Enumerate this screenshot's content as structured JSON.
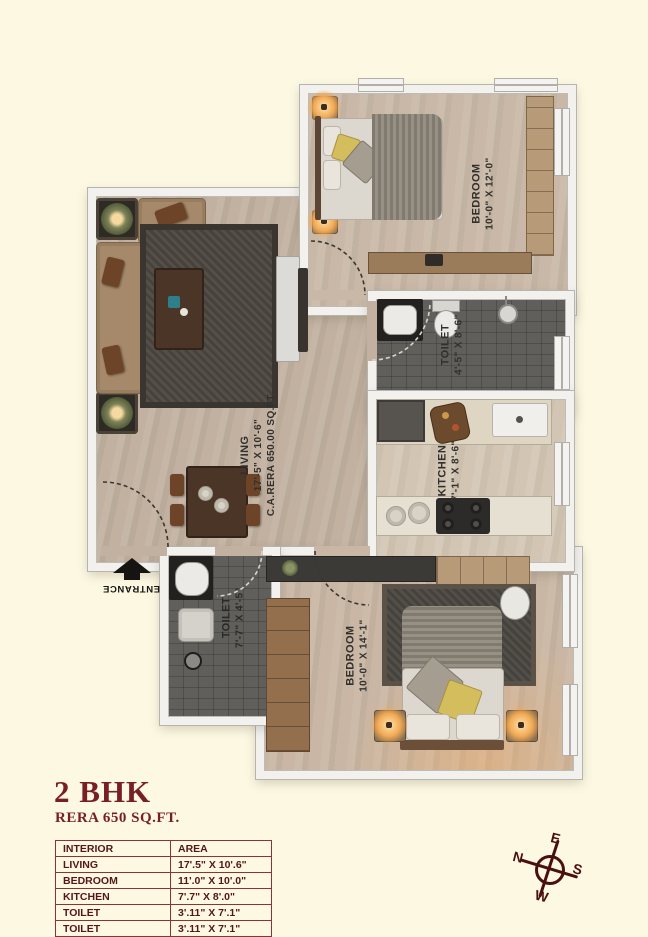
{
  "title": {
    "heading": "2 BHK",
    "subheading": "RERA 650 SQ.FT."
  },
  "plan": {
    "entrance_label": "ENTRANCE",
    "rooms": {
      "bedroom1": {
        "name": "BEDROOM",
        "dims": "10'-0\" X 12'-0\""
      },
      "toilet1": {
        "name": "TOILET",
        "dims": "4'-5\" X 8'-6\""
      },
      "kitchen": {
        "name": "KITCHEN",
        "dims": "7'-1\" X 8'-6\""
      },
      "living": {
        "name": "LIVING",
        "dims": "17'-5\" X 10'-6\"",
        "rera": "C.A.RERA 650.00 SQ.FT"
      },
      "toilet2": {
        "name": "TOILET",
        "dims": "7'-7\" X 4'-5\""
      },
      "bedroom2": {
        "name": "BEDROOM",
        "dims": "10'-0\" X 14'-1\""
      }
    }
  },
  "area_table": {
    "headers": [
      "INTERIOR",
      "AREA"
    ],
    "rows": [
      [
        "LIVING",
        "17'.5\" X 10'.6\""
      ],
      [
        "BEDROOM",
        "11'.0\" X 10'.0\""
      ],
      [
        "KITCHEN",
        "7'.7\" X 8'.0\""
      ],
      [
        "TOILET",
        "3'.11\" X 7'.1\""
      ],
      [
        "TOILET",
        "3'.11\" X 7'.1\""
      ]
    ]
  },
  "compass": {
    "north": "N",
    "east": "E",
    "south": "S",
    "west": "W"
  },
  "colors": {
    "accent_maroon": "#771f23",
    "wall": "#f2f1ee",
    "floor_tan": "#c2b1a0",
    "tile_dark": "#615f5b",
    "background": "#fcf8e2"
  }
}
